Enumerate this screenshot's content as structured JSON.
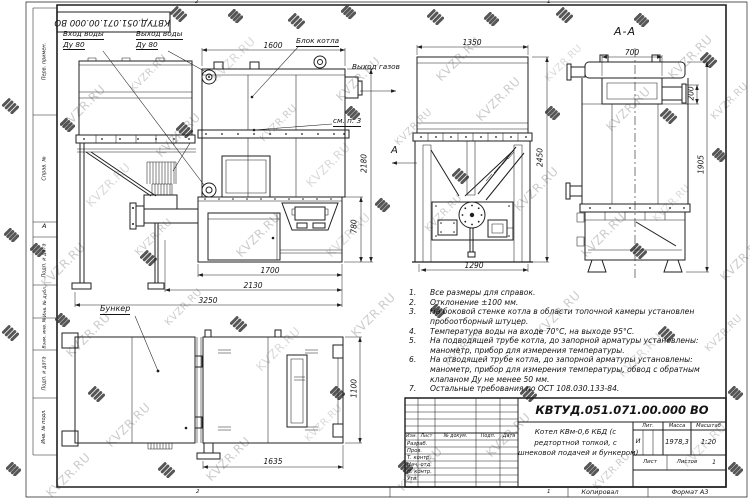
{
  "sheet": {
    "stamp_top": "КВТУД.051.071.00.000 ВО",
    "copied_label": "Копировал",
    "format_label": "Формат А3",
    "zone_top": [
      "2",
      "1"
    ],
    "zone_bottom": [
      "2",
      "1"
    ],
    "zone_letter": "А",
    "side_labels": [
      "Перв. примен.",
      "Справ. №",
      "Подп. и дата",
      "Инв. № дубл.",
      "Взам. инв. №",
      "Подп. и дата",
      "Инв. № подл."
    ]
  },
  "watermark": {
    "text": "KVZR.RU"
  },
  "views": {
    "section_title": "А-А",
    "view_arrow_letter": "А"
  },
  "callouts": {
    "water_in_1": "Вход воды",
    "water_in_2": "Ду 80",
    "water_out_1": "Выход воды",
    "water_out_2": "Ду 80",
    "boiler_block": "Блок котла",
    "gas_out": "Выход газов",
    "see_note": "см. п. 3",
    "bunker": "Бункер"
  },
  "dims": {
    "front_top": "1600",
    "front_height": "2180",
    "front_lower": "780",
    "front_w1700": "1700",
    "front_w2130": "2130",
    "front_w3250": "3250",
    "mid_top": "1350",
    "mid_height": "2450",
    "mid_bottom": "1290",
    "sec_top": "700",
    "sec_h200": "200",
    "sec_h1905": "1905",
    "plan_h1100": "1100",
    "plan_w1635": "1635"
  },
  "notes": [
    {
      "num": "1.",
      "text": "Все размеры для справок."
    },
    {
      "num": "2.",
      "text": "Отклонение ±100 мм."
    },
    {
      "num": "3.",
      "text": "На боковой стенке котла в области топочной камеры установлен пробоотборный штуцер."
    },
    {
      "num": "4.",
      "text": "Температура воды на входе 70°С, на выходе 95°С."
    },
    {
      "num": "5.",
      "text": "На подводящей трубе котла, до запорной арматуры установлены: манометр, прибор для измерения температуры."
    },
    {
      "num": "6.",
      "text": "На отводящей трубе котла, до запорной арматуры установлены: манометр, прибор для измерения температуры, обвод с обратным клапаном Ду не менее 50 мм."
    },
    {
      "num": "7.",
      "text": "Остальные требования по ОСТ 108.030.133-84."
    }
  ],
  "title_block": {
    "designation": "КВТУД.051.071.00.000 ВО",
    "name_lines": [
      "Котел КВм-0,6 КБД (с",
      "редтортной топкой, с",
      "шнековой подачей и бункером)"
    ],
    "header_cols": [
      "Изм.",
      "Лист",
      "№ докум.",
      "Подп.",
      "Дата"
    ],
    "rows": [
      "Разраб.",
      "Пров.",
      "Т. контр.",
      "Нач. отд.",
      "Н. контр.",
      "Утв."
    ],
    "lit_label": "Лит.",
    "mass_label": "Масса",
    "scale_label": "Масштаб",
    "lit_value": "И",
    "mass_value": "1978,3",
    "scale_value": "1:20",
    "sheet_label": "Лист",
    "sheets_label": "Листов",
    "sheets_value": "1"
  }
}
